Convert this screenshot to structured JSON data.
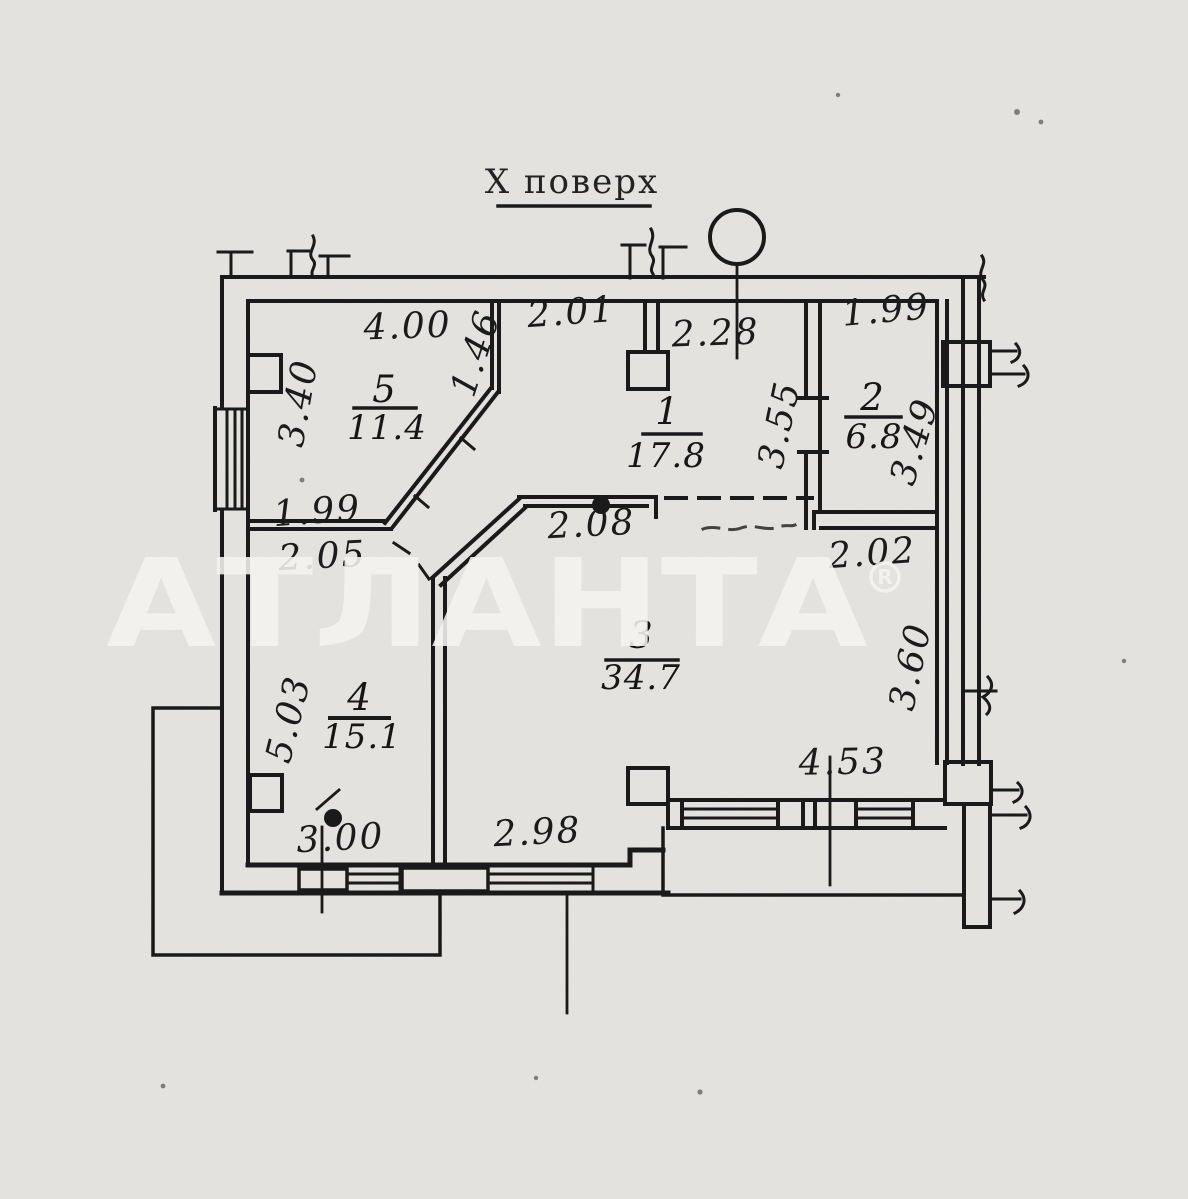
{
  "title": "Х поверх",
  "watermark": {
    "text": "АТЛАНТА",
    "reg_mark": "R"
  },
  "colors": {
    "paper": "#e6e5e2",
    "ink": "#1a1a1a",
    "circle_fill": "#f7f6f4",
    "watermark": "#f4f3f0"
  },
  "rooms": {
    "r1": {
      "number": "1",
      "area": "17.8"
    },
    "r2": {
      "number": "2",
      "area": "6.8"
    },
    "r3": {
      "number": "3",
      "area": "34.7"
    },
    "r4": {
      "number": "4",
      "area": "15.1"
    },
    "r5": {
      "number": "5",
      "area": "11.4"
    }
  },
  "dimensions": {
    "room5_top": "4.00",
    "room5_left": "3.40",
    "room5_diag": "1.46",
    "room5_bottom": "1.99",
    "room4_top": "2.05",
    "room4_left": "5.03",
    "room4_bottom": "3.00",
    "room1_top_left": "2.01",
    "room1_top_right": "2.28",
    "room1_right": "3.55",
    "room2_top": "1.99",
    "room2_right": "3.49",
    "room2_bottom": "2.02",
    "room3_top": "2.08",
    "room3_right": "3.60",
    "room3_bottom_left": "2.98",
    "room3_bottom_right": "4.53"
  }
}
